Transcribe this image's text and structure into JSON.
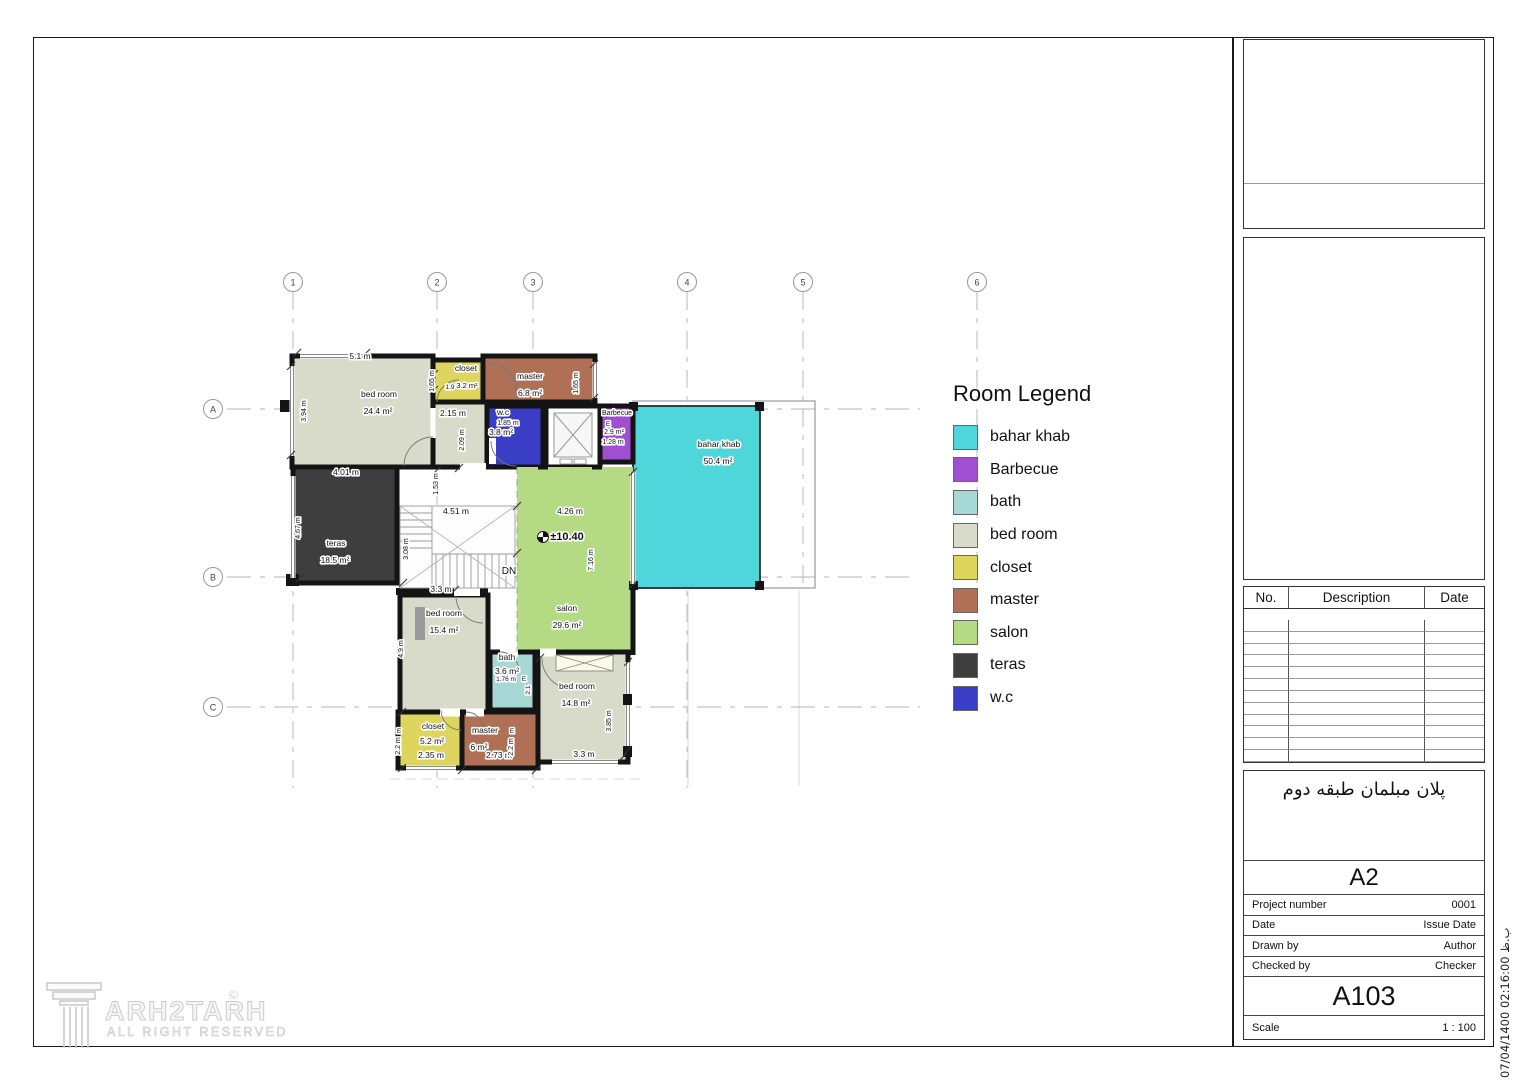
{
  "grid": {
    "columns": [
      "1",
      "2",
      "3",
      "4",
      "5",
      "6"
    ],
    "rows": [
      "A",
      "B",
      "C"
    ]
  },
  "legend": {
    "title": "Room Legend",
    "items": [
      {
        "key": "baharkhab",
        "label": "bahar khab",
        "color": "#4fd6db"
      },
      {
        "key": "barbecue",
        "label": "Barbecue",
        "color": "#a04fd3"
      },
      {
        "key": "bath",
        "label": "bath",
        "color": "#a6d9d6"
      },
      {
        "key": "bedroom",
        "label": "bed room",
        "color": "#d8dbc9"
      },
      {
        "key": "closet",
        "label": "closet",
        "color": "#ddd55e"
      },
      {
        "key": "master",
        "label": "master",
        "color": "#b07055"
      },
      {
        "key": "salon",
        "label": "salon",
        "color": "#b4db83"
      },
      {
        "key": "teras",
        "label": "teras",
        "color": "#3e3e3e"
      },
      {
        "key": "wc",
        "label": "w.c",
        "color": "#3a3ec6"
      }
    ]
  },
  "plan": {
    "labels": [
      {
        "t": "5.1 m",
        "x": 360,
        "y": 359
      },
      {
        "t": "bed room",
        "x": 379,
        "y": 397
      },
      {
        "t": "24.4 m²",
        "x": 378,
        "y": 414
      },
      {
        "t": "3.94 m",
        "x": 306,
        "y": 411,
        "r": 1,
        "s": 7
      },
      {
        "t": "closet",
        "x": 466,
        "y": 371
      },
      {
        "t": "1.9",
        "x": 450,
        "y": 389,
        "s": 6.5
      },
      {
        "t": "3.2 m²",
        "x": 467,
        "y": 388,
        "s": 7.5
      },
      {
        "t": "1.65 m",
        "x": 434,
        "y": 381,
        "r": 1,
        "s": 7
      },
      {
        "t": "master",
        "x": 530,
        "y": 379
      },
      {
        "t": "6.8 m²",
        "x": 530,
        "y": 396
      },
      {
        "t": "1.65 m",
        "x": 578,
        "y": 383,
        "r": 1,
        "s": 7
      },
      {
        "t": "2.15 m",
        "x": 453,
        "y": 416
      },
      {
        "t": "2.09 m",
        "x": 464,
        "y": 440,
        "r": 1,
        "s": 7
      },
      {
        "t": "w.c",
        "x": 503,
        "y": 415
      },
      {
        "t": "1.85 m",
        "x": 508,
        "y": 425,
        "s": 7
      },
      {
        "t": "3.8 m²",
        "x": 501,
        "y": 435
      },
      {
        "t": "Barbecue",
        "x": 617,
        "y": 415,
        "s": 7
      },
      {
        "t": "E",
        "x": 608,
        "y": 426,
        "s": 6.5
      },
      {
        "t": "2.9 m²",
        "x": 614,
        "y": 434,
        "s": 7
      },
      {
        "t": "1.28 m",
        "x": 613,
        "y": 444,
        "s": 7
      },
      {
        "t": "bahar khab",
        "x": 719,
        "y": 447
      },
      {
        "t": "50.4 m²",
        "x": 718,
        "y": 464
      },
      {
        "t": "4.01 m",
        "x": 346,
        "y": 475
      },
      {
        "t": "1.53 m",
        "x": 438,
        "y": 484,
        "r": 1,
        "s": 7
      },
      {
        "t": "4.67 m",
        "x": 300,
        "y": 528,
        "r": 1,
        "s": 7
      },
      {
        "t": "teras",
        "x": 336,
        "y": 546
      },
      {
        "t": "18.5 m²",
        "x": 335,
        "y": 563
      },
      {
        "t": "4.51 m",
        "x": 456,
        "y": 514
      },
      {
        "t": "3.08 m",
        "x": 408,
        "y": 549,
        "r": 1,
        "s": 7
      },
      {
        "t": "4.26 m",
        "x": 570,
        "y": 514
      },
      {
        "t": "±10.40",
        "x": 567,
        "y": 540,
        "s": 11,
        "b": 1
      },
      {
        "t": "7.16 m",
        "x": 593,
        "y": 560,
        "r": 1,
        "s": 7
      },
      {
        "t": "DN",
        "x": 509,
        "y": 574,
        "s": 10
      },
      {
        "t": "3.3 m",
        "x": 441,
        "y": 592
      },
      {
        "t": "salon",
        "x": 567,
        "y": 611
      },
      {
        "t": "29.6 m²",
        "x": 567,
        "y": 628
      },
      {
        "t": "bed room",
        "x": 444,
        "y": 616
      },
      {
        "t": "15.4 m²",
        "x": 444,
        "y": 633
      },
      {
        "t": "4.9 m",
        "x": 403,
        "y": 649,
        "r": 1,
        "s": 7
      },
      {
        "t": "bath",
        "x": 507,
        "y": 660
      },
      {
        "t": "3.6 m²",
        "x": 507,
        "y": 674
      },
      {
        "t": "1.76 m",
        "x": 506,
        "y": 681,
        "s": 6.5
      },
      {
        "t": "E",
        "x": 524,
        "y": 681,
        "s": 6.5
      },
      {
        "t": "2.1",
        "x": 530,
        "y": 690,
        "r": 1,
        "s": 6.5
      },
      {
        "t": "bed room",
        "x": 577,
        "y": 689
      },
      {
        "t": "14.8 m²",
        "x": 576,
        "y": 706
      },
      {
        "t": "3.85 m",
        "x": 611,
        "y": 721,
        "r": 1,
        "s": 7
      },
      {
        "t": "3.3 m",
        "x": 584,
        "y": 757
      },
      {
        "t": "closet",
        "x": 433,
        "y": 729
      },
      {
        "t": "5.2 m²",
        "x": 432,
        "y": 744
      },
      {
        "t": "2.35 m",
        "x": 431,
        "y": 758
      },
      {
        "t": "E",
        "x": 399,
        "y": 733,
        "s": 6.5
      },
      {
        "t": "2.2 m",
        "x": 400,
        "y": 746,
        "r": 1,
        "s": 7
      },
      {
        "t": "master",
        "x": 485,
        "y": 733
      },
      {
        "t": "6 m²",
        "x": 479,
        "y": 750
      },
      {
        "t": "2.73 m",
        "x": 499,
        "y": 758
      },
      {
        "t": "E",
        "x": 512,
        "y": 733,
        "s": 6.5
      },
      {
        "t": "2.2 m",
        "x": 513,
        "y": 747,
        "r": 1,
        "s": 7
      }
    ]
  },
  "revision_table": {
    "headers": [
      "No.",
      "Description",
      "Date"
    ],
    "empty_rows": 12
  },
  "titleblock": {
    "title_fa": "پلان مبلمان طبقه دوم",
    "format": "A2",
    "fields": [
      {
        "label": "Project number",
        "value": "0001"
      },
      {
        "label": "Date",
        "value": "Issue Date"
      },
      {
        "label": "Drawn by",
        "value": "Author"
      },
      {
        "label": "Checked by",
        "value": "Checker"
      }
    ],
    "sheet_number": "A103",
    "scale_label": "Scale",
    "scale_value": "1 : 100"
  },
  "side_stamp": "07/04/1400 02:16:00 ب.ظ",
  "logo": {
    "main": "ARH2TARH",
    "tagline": "ALL RIGHT RESERVED",
    "copyright": "©"
  }
}
